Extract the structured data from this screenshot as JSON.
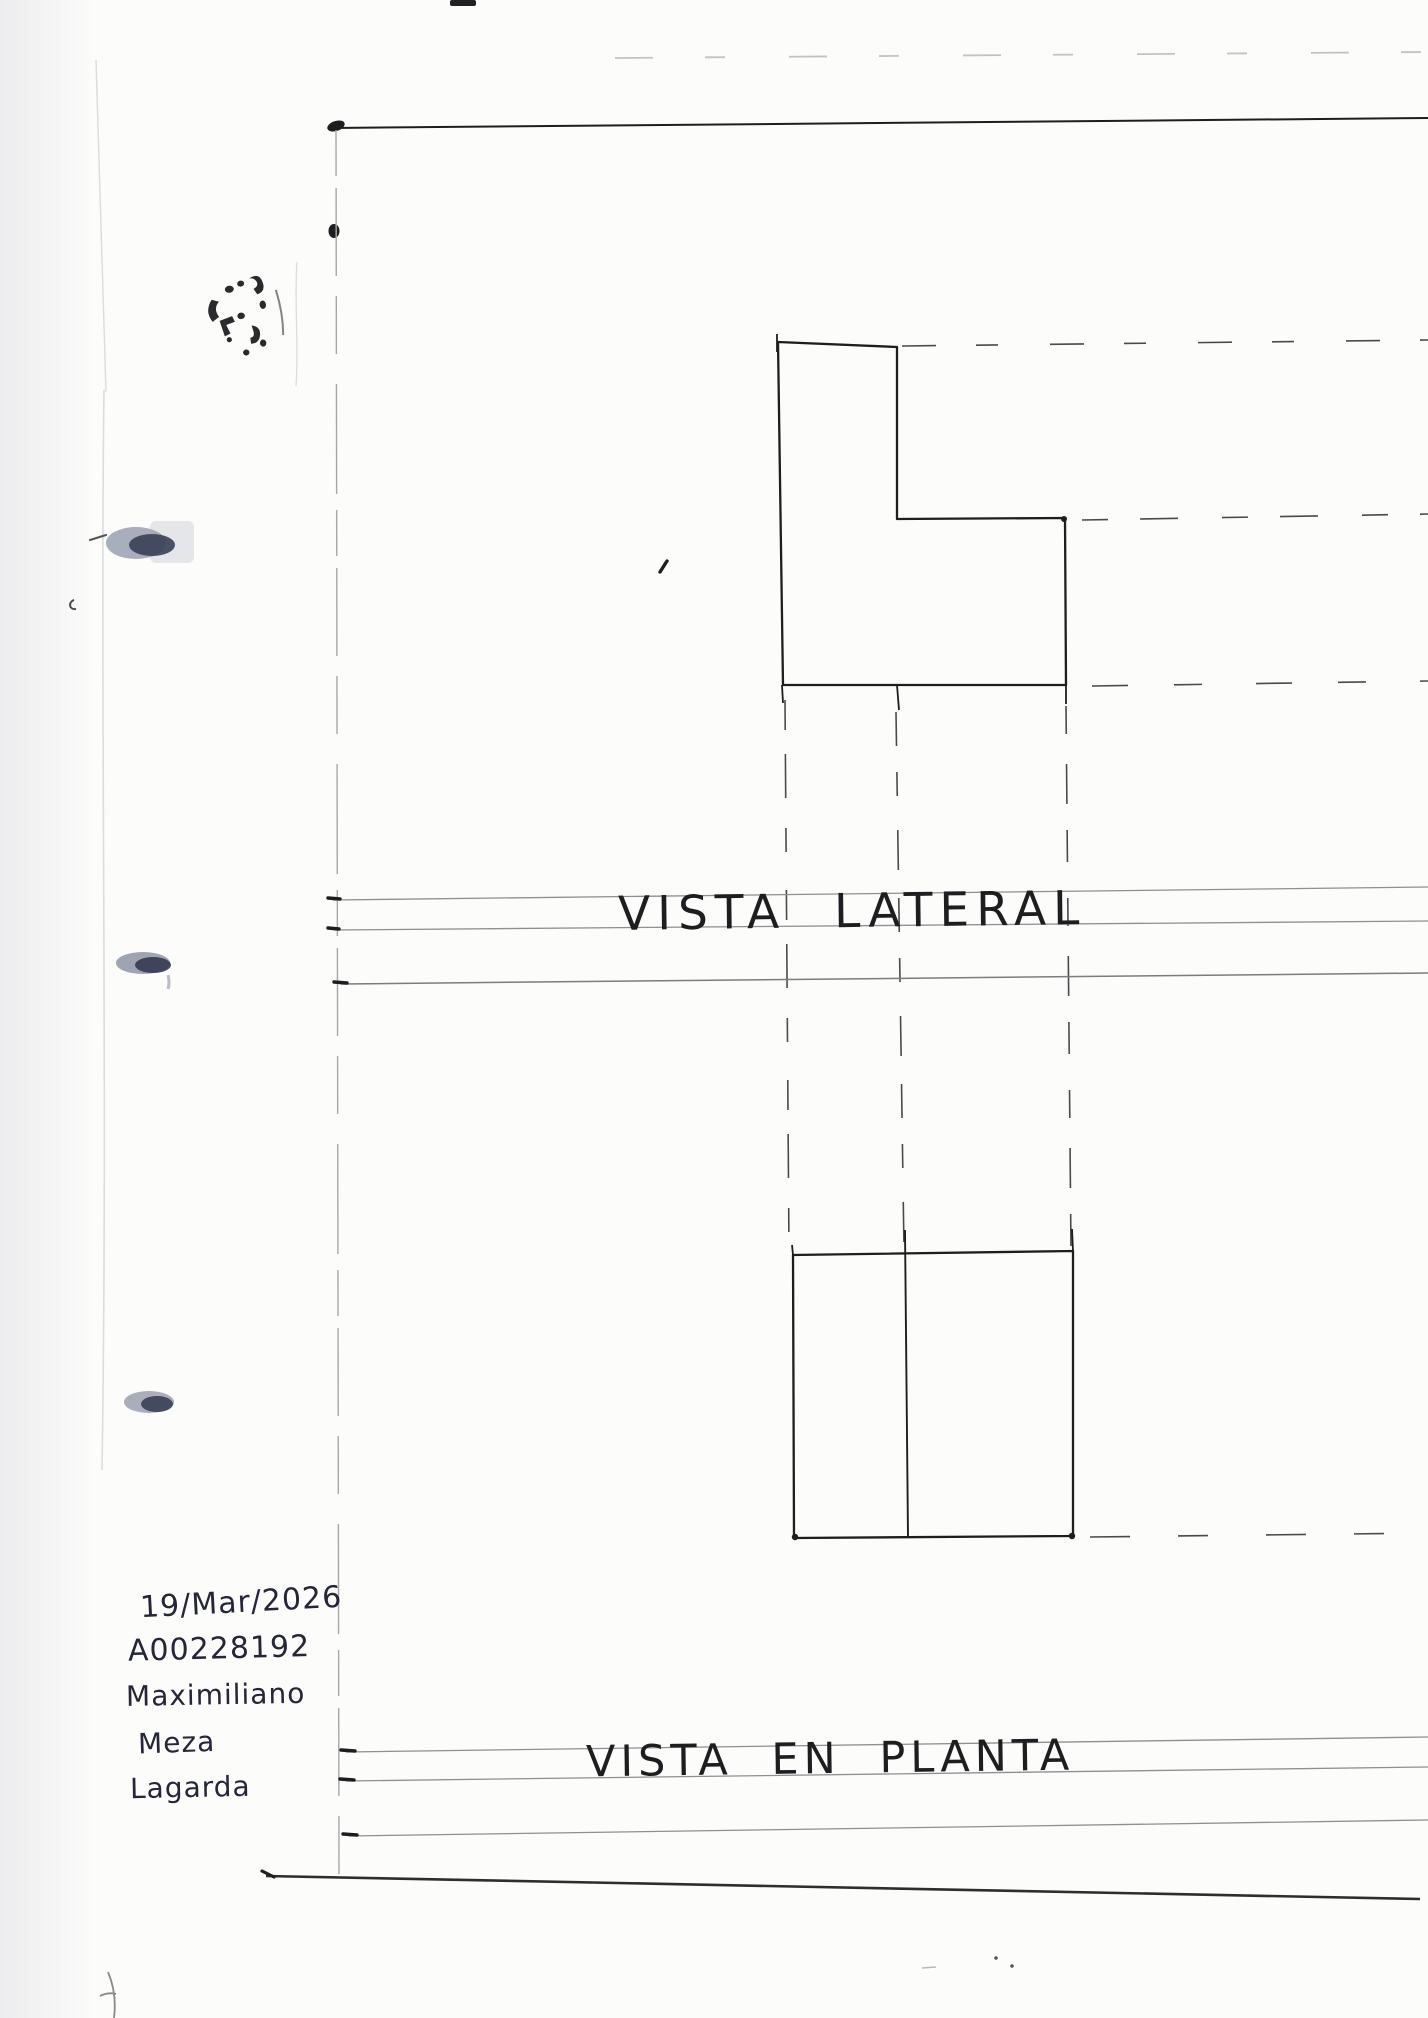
{
  "titles": {
    "lateral_view": "VISTA LATERAL",
    "plan_view": "VISTA EN PLANTA"
  },
  "annotations": {
    "date": "19/Mar/2026",
    "student_id": "A00228192",
    "name": [
      "Maximiliano",
      "Meza",
      "Lagarda"
    ]
  },
  "icons": {
    "stamp": "ink-stamp-smudge",
    "binder_marks": "binder-hole-shadow"
  },
  "theme": {
    "ink": "#1e1e20",
    "pencil": "#8f8f93",
    "dash-ink": "#4a4a4e",
    "faint": "#c3c3c7",
    "crease": "#dcdcde",
    "handwriting": "#26263a",
    "binder-light": "#9aa0b0",
    "binder-dark": "#3a4054",
    "paper": "#fcfcfb"
  }
}
